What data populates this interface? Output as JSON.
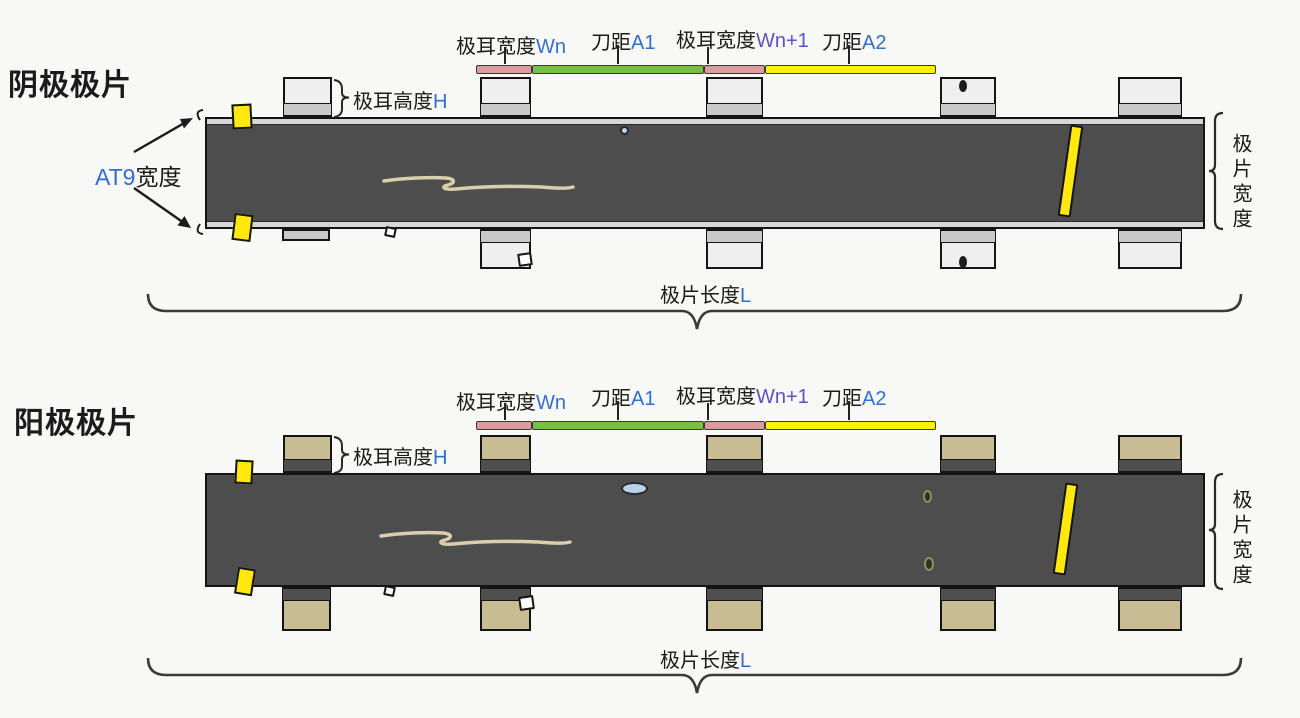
{
  "page": {
    "background": "#f8f8f6"
  },
  "colors": {
    "page_bg": "#f8f8f6",
    "ink": "#1b1b1b",
    "variable_blue": "#2e6fd6",
    "variable_purple": "#5b50c8",
    "outline": "#141414",
    "strip_dark": "#4d4d4d",
    "strip_edge_light": "#d7d7d7",
    "cathode_tab_body": "#efefef",
    "cathode_tab_band": "#c9c9c9",
    "anode_tab_body": "#c8bc92",
    "anode_tab_band": "#4f4f4f",
    "bar_pink": "#dd9c9c",
    "bar_green": "#76c043",
    "bar_yellow": "#fff200",
    "marker_yellow": "#ffe80d",
    "scratch": "#d9cfad",
    "defect_blue": "#b9d2ea",
    "brace_stroke": "#3a3a3a"
  },
  "diagrams": {
    "cathode": {
      "title": "阴极极片",
      "at9": {
        "var": "AT9",
        "text": "宽度"
      }
    },
    "anode": {
      "title": "阳极极片"
    }
  },
  "dim_labels": {
    "tab_width": {
      "text": "极耳宽度",
      "var": "Wn"
    },
    "knife_a1": {
      "text": "刀距",
      "var": "A1"
    },
    "tab_width_next": {
      "text": "极耳宽度",
      "var": "Wn+1"
    },
    "knife_a2": {
      "text": "刀距",
      "var": "A2"
    },
    "tab_height": {
      "text": "极耳高度",
      "var": "H"
    },
    "sheet_width": {
      "text": "极片宽度"
    },
    "sheet_length": {
      "text": "极片长度",
      "var": "L"
    }
  }
}
